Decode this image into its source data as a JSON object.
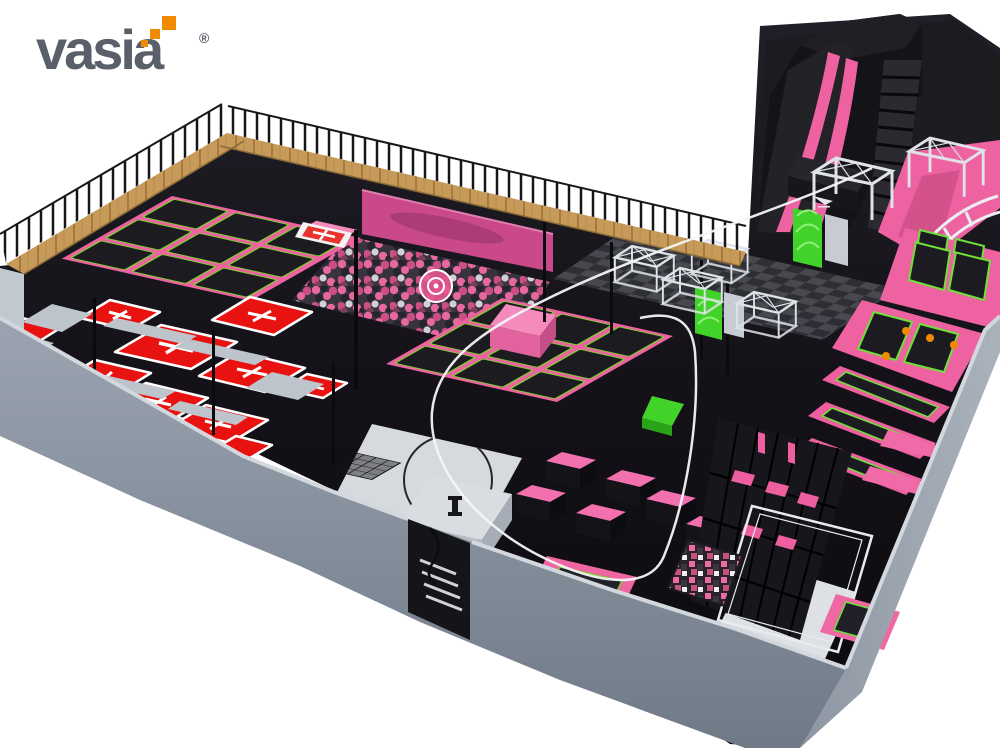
{
  "brand": {
    "name": "vasia",
    "registered_mark": "®"
  },
  "palette": {
    "red": "#e81310",
    "pink": "#ee62a2",
    "pink_light": "#f58abc",
    "magenta": "#c9498a",
    "green": "#42d32a",
    "wood": "#c69b5a",
    "wall_gray": "#939ca8",
    "wall_edge": "#d3d8de",
    "floor_black": "#131217",
    "court_gray": "#d6d9de",
    "orange": "#f18a00",
    "logo_gray": "#59606a",
    "truss_silver": "#dfe3e8",
    "white": "#f4f5f7"
  },
  "scene": {
    "areas": [
      "mezzanine-walkway",
      "foam-ball-pit",
      "free-jump-trampoline-grid",
      "dodgeball-courts",
      "drop-slide",
      "stairs",
      "ninja-truss-course",
      "climbing-walls",
      "wall-trampolines",
      "tumble-lanes",
      "parkour-blocks",
      "zipline",
      "basketball-court",
      "foam-cube-pit",
      "entrance-stairs",
      "info-kiosk",
      "perimeter-wall"
    ]
  }
}
